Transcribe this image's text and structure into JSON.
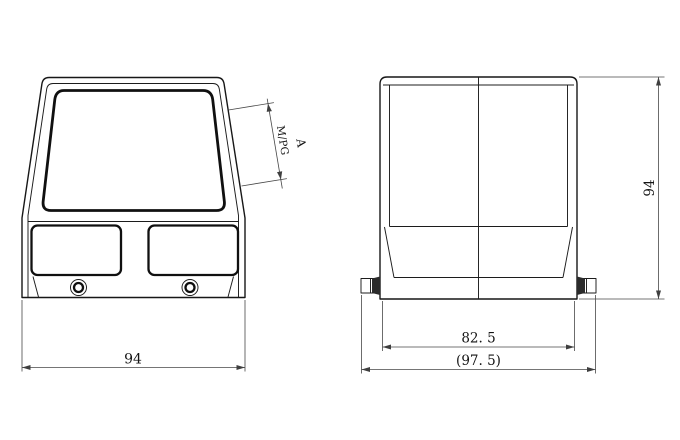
{
  "drawing": {
    "dimensions": {
      "front_width": "94",
      "side_height": "94",
      "flange_width": "82. 5",
      "overall_width": "(97. 5)",
      "cable_entry_thread": "M/PG",
      "cable_entry_label": "A"
    },
    "colors": {
      "background": "#ffffff",
      "object_line": "#171717",
      "dimension_line": "#474747"
    }
  }
}
